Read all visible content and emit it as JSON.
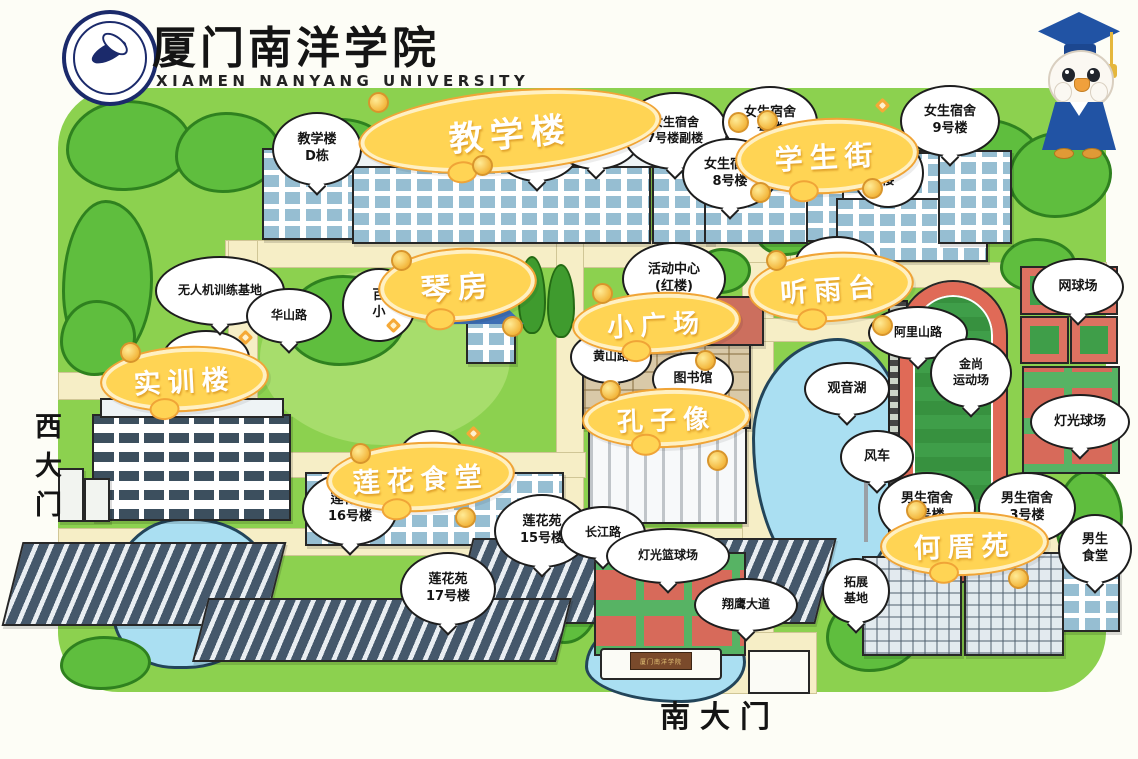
{
  "branding": {
    "title_zh": "厦门南洋学院",
    "title_en": "XIAMEN  NANYANG  UNIVERSITY"
  },
  "gates": {
    "west": "西大门",
    "south": "南大门",
    "south_sign": "厦门南洋学院"
  },
  "area_labels": {
    "teaching": "教学楼",
    "student_street": "学生街",
    "piano": "琴房",
    "small_square": "小广场",
    "rain_pavilion": "听雨台",
    "training": "实训楼",
    "confucius": "孔子像",
    "lotus_canteen": "莲花食堂",
    "hecuo": "何厝苑"
  },
  "bubbles": {
    "teaching_d": "教学楼\nD栋",
    "teaching_b": "教学楼\nB栋",
    "teaching_a": "教学楼\nA栋",
    "girls7": "女生宿舍\n7号楼副楼",
    "girls6": "女生宿舍\n号楼",
    "girls8": "女生宿舍\n8号楼",
    "girls9": "女生宿舍\n9号楼",
    "girls_partial": "舍\n楼",
    "drone": "无人机训练基地",
    "huashan": "华山路",
    "training_small": "实训楼",
    "activity": "活动中心\n(红楼)",
    "huanghe": "黄河路",
    "alishan": "阿里山路",
    "huangshan": "黄山路",
    "library": "图书馆",
    "guanyin": "观音湖",
    "tennis": "网球场",
    "jinshang": "金尚\n运动场",
    "light_court": "灯光球场",
    "windmill": "风车",
    "boys1": "男生宿舍\n1号楼",
    "boys3": "男生宿舍\n3号楼",
    "boys_canteen": "男生\n食堂",
    "expansion": "拓展\n基地",
    "lotus16": "莲花苑\n16号楼",
    "lotus15": "莲花苑\n15号楼",
    "lotus17": "莲花苑\n17号楼",
    "changjiang": "长江路",
    "light_basketball": "灯光篮球场",
    "xiangying": "翔鹰大道",
    "partial_bai": "百\n小",
    "partial_lotus": "莲花"
  },
  "colors": {
    "map_green": "#8cd14f",
    "tree_green": "#5fbe3e",
    "road_cream": "#f6eec6",
    "label_yellow": "#ffd454",
    "label_border_orange": "#f0a437",
    "water_blue": "#aadff2",
    "track_red": "#e06a57",
    "mascot_blue": "#2153a4"
  }
}
